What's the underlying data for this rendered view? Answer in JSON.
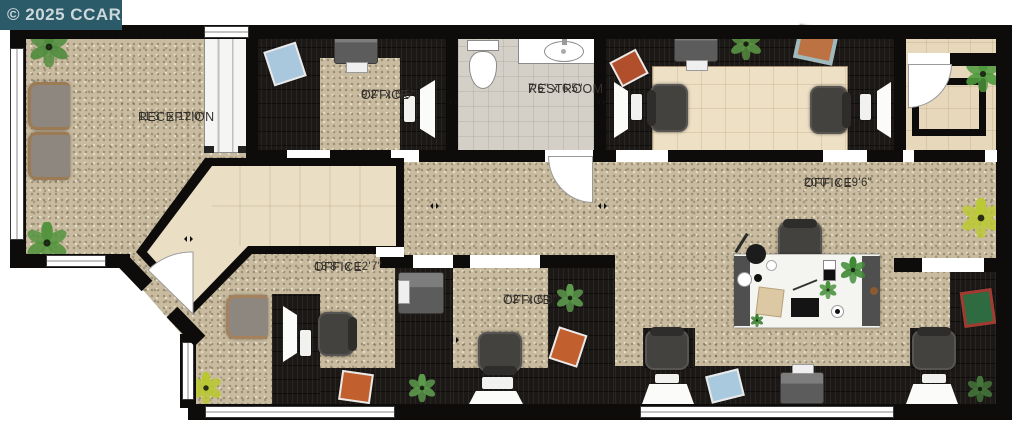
{
  "watermark": {
    "text": "© 2025 CCAR"
  },
  "rooms": [
    {
      "id": "reception",
      "name": "RECEPTION",
      "dims": "11'3\" x 12'0\""
    },
    {
      "id": "office-top-small",
      "name": "OFFICE",
      "dims": "9'2\" x 6'5\""
    },
    {
      "id": "restroom",
      "name": "RESTROOM",
      "dims": "7'6\" x 6'5\""
    },
    {
      "id": "office-large",
      "name": "OFFICE",
      "dims": "20'0\" x 19'6\""
    },
    {
      "id": "office-mid",
      "name": "OFFICE",
      "dims": "13'8\" x 12'7\""
    },
    {
      "id": "office-bot-small",
      "name": "OFFICE",
      "dims": "7'2\" x 6'8\""
    }
  ],
  "colors": {
    "watermark_bg": "#2b5a69",
    "watermark_text": "#ccd7db",
    "carpet": "#c8bb9f",
    "dark_floor": "#1b1816",
    "corridor_tile": "#eadfc4",
    "restroom_tile": "#d4d0c8",
    "vestibule_tile": "#e7d8bc",
    "wall": "#0d0c0b",
    "label_text": "#34302b"
  }
}
